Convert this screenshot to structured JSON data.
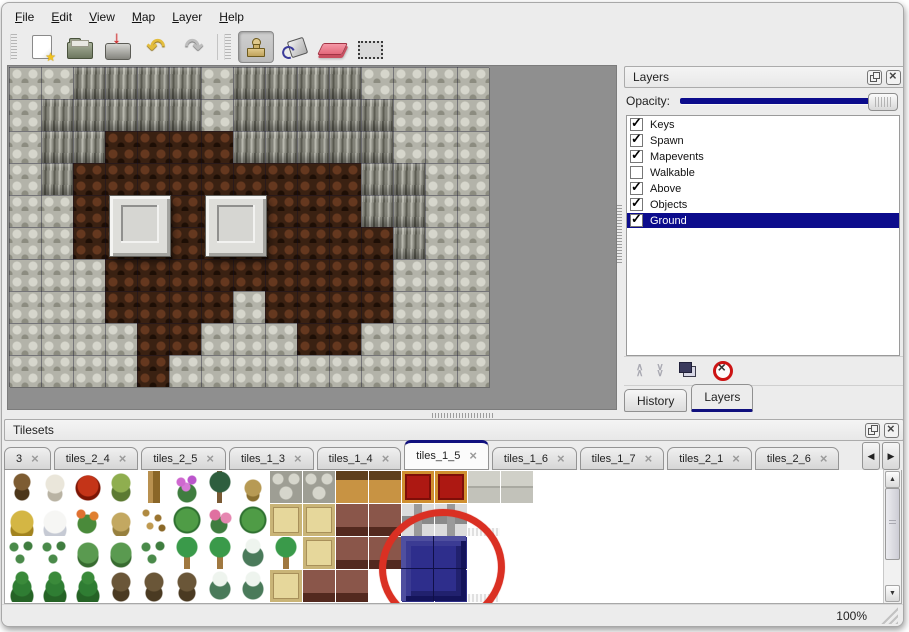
{
  "menu": {
    "items": [
      "File",
      "Edit",
      "View",
      "Map",
      "Layer",
      "Help"
    ]
  },
  "toolbar": {
    "buttons": [
      {
        "name": "new-file",
        "icon": "new-file-icon"
      },
      {
        "name": "open",
        "icon": "open-folder-icon"
      },
      {
        "name": "save",
        "icon": "save-icon"
      },
      {
        "name": "undo",
        "icon": "undo-icon",
        "glyph": "↶"
      },
      {
        "name": "redo",
        "icon": "redo-icon",
        "glyph": "↷"
      },
      {
        "name": "stamp-tool",
        "icon": "stamp-icon",
        "active": true
      },
      {
        "name": "fill-tool",
        "icon": "paint-bucket-icon"
      },
      {
        "name": "eraser-tool",
        "icon": "eraser-icon"
      },
      {
        "name": "select-tool",
        "icon": "selection-icon"
      }
    ]
  },
  "map": {
    "tile_size": 32,
    "cols": 15,
    "rows": 10,
    "legend": {
      "g": "gray-scale-ground",
      "c": "cliff-rock",
      "b": "brown-roof"
    },
    "grid": [
      "ggccccgccccgggg",
      "gcccccgcccccggg",
      "gccbbbbcccccggg",
      "gcbbbbbbbbbccgg",
      "ggbbbbbbbbbccgg",
      "ggbbbbbbbbbbcgg",
      "gggbbbbbbbbbggg",
      "gggbbbbgbbbbggg",
      "ggggbbgggbbgggg",
      "ggggbgggggggggg"
    ],
    "objects": [
      {
        "type": "window",
        "x": 100,
        "y": 128
      },
      {
        "type": "window",
        "x": 196,
        "y": 128
      }
    ]
  },
  "layers_panel": {
    "title": "Layers",
    "opacity_label": "Opacity:",
    "opacity_percent": 100,
    "layers": [
      {
        "name": "Keys",
        "checked": true,
        "selected": false
      },
      {
        "name": "Spawn",
        "checked": true,
        "selected": false
      },
      {
        "name": "Mapevents",
        "checked": true,
        "selected": false
      },
      {
        "name": "Walkable",
        "checked": false,
        "selected": false
      },
      {
        "name": "Above",
        "checked": true,
        "selected": false
      },
      {
        "name": "Objects",
        "checked": true,
        "selected": false
      },
      {
        "name": "Ground",
        "checked": true,
        "selected": true
      }
    ],
    "footer_buttons": [
      "raise-layer",
      "lower-layer",
      "duplicate-layer",
      "delete-layer"
    ],
    "dock_tabs": [
      {
        "label": "History",
        "active": false
      },
      {
        "label": "Layers",
        "active": true
      }
    ]
  },
  "tilesets_panel": {
    "title": "Tilesets",
    "tabs": [
      {
        "label": "3",
        "active": false
      },
      {
        "label": "tiles_2_4",
        "active": false
      },
      {
        "label": "tiles_2_5",
        "active": false
      },
      {
        "label": "tiles_1_3",
        "active": false
      },
      {
        "label": "tiles_1_4",
        "active": false
      },
      {
        "label": "tiles_1_5",
        "active": true
      },
      {
        "label": "tiles_1_6",
        "active": false
      },
      {
        "label": "tiles_1_7",
        "active": false
      },
      {
        "label": "tiles_2_1",
        "active": false
      },
      {
        "label": "tiles_2_6",
        "active": false
      }
    ],
    "palette": {
      "legend": {
        "t1": "dead-tree",
        "t2": "white-branches",
        "f1": "red-flower",
        "st": "stump",
        "tr": "trunk",
        "f2": "purple-flowers",
        "p1": "dark-palm",
        "wd": "dry-weed",
        "sf": "stone-floor",
        "wo": "wood-shelf",
        "cp": "red-carpet",
        "s2": "stone-blocks",
        "hy": "hay-mound",
        "sn": "snow-mound",
        "f3": "orange-flowers",
        "gd": "dry-grass",
        "lv": "leaves",
        "ly": "lily-pad",
        "f4": "pink-flowers",
        "tn": "tan-tile",
        "tb": "wooden-table",
        "fr": "gray-frame",
        "wf": "white-cloth",
        "em": "empty",
        "sh": "shrubs",
        "bu": "bush",
        "pm": "palm-tree",
        "ps": "snowy-pine",
        "cf": "conifer",
        "tg": "gnarled-tree",
        "bl": "blue-window-tile"
      },
      "rows": [
        [
          "t1",
          "t2",
          "f1",
          "st",
          "tr",
          "f2",
          "p1",
          "wd",
          "sf",
          "sf",
          "wo",
          "wo",
          "cp",
          "cp",
          "s2",
          "s2"
        ],
        [
          "hy",
          "sn",
          "f3",
          "gd",
          "lv",
          "ly",
          "f4",
          "ly",
          "tn",
          "tn",
          "tb",
          "tb",
          "fr",
          "fr",
          "wf",
          "em"
        ],
        [
          "sh",
          "sh",
          "bu",
          "bu",
          "sh",
          "pm",
          "pm",
          "ps",
          "pm",
          "tn",
          "tb",
          "tb",
          "bl",
          "bl",
          "em",
          "em"
        ],
        [
          "cf",
          "cf",
          "cf",
          "tg",
          "tg",
          "tg",
          "ps",
          "ps",
          "tn",
          "tb",
          "tb",
          "em",
          "bl",
          "bl",
          "wf",
          "em"
        ]
      ],
      "selected_tile": "blue-window-2x2",
      "annotation": "red-circle"
    }
  },
  "statusbar": {
    "zoom": "100%"
  },
  "colors": {
    "accent_navy": "#0c0c8c",
    "selection_bg": "#0c0c8c",
    "annotation_red": "#da3023",
    "eraser_pink": "#e3697b",
    "canvas_bg": "#8f8f8f",
    "window_bg": "#ececec"
  }
}
